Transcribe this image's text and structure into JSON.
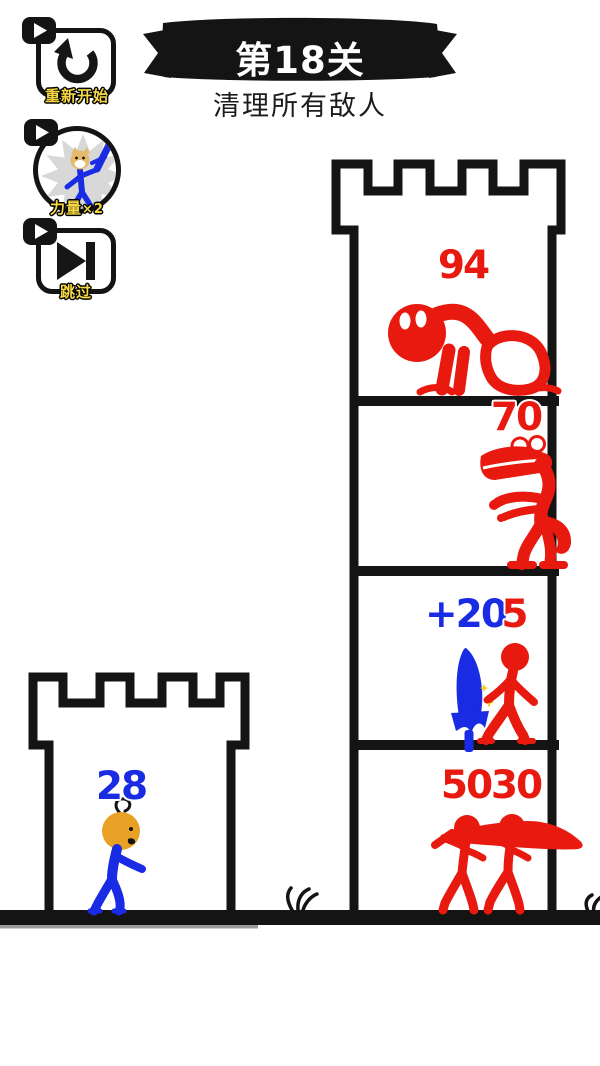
{
  "header": {
    "level": "第18关",
    "objective": "清理所有敌人"
  },
  "buttons": {
    "restart": {
      "label": "重新开始",
      "icon": "restart-arrow"
    },
    "power": {
      "label": "力量",
      "multiplier": "×2",
      "icon": "stickman-with-sword"
    },
    "skip": {
      "label": "跳过",
      "icon": "skip-forward"
    },
    "ad_icon": "video-play"
  },
  "player": {
    "hp": "28",
    "color": "#1a2be4",
    "head_color": "#e8a125"
  },
  "bonus_pickup": {
    "label": "+20",
    "item": "blue-sword",
    "color": "#1a2be4"
  },
  "enemies": {
    "floor1": {
      "hp": "94",
      "type": "crawler-monster"
    },
    "floor2": {
      "hp": "70",
      "type": "crocodile"
    },
    "floor3": {
      "hp": "5",
      "type": "stickman"
    },
    "floor4_left": {
      "hp": "50",
      "type": "sword-carrier"
    },
    "floor4_right": {
      "hp": "30",
      "type": "sword-carrier"
    }
  },
  "colors": {
    "enemy_red": "#e8190e",
    "player_blue": "#1a2be4",
    "button_label_yellow": "#f6d844",
    "banner_black": "#141414",
    "head_orange": "#e8a125"
  }
}
